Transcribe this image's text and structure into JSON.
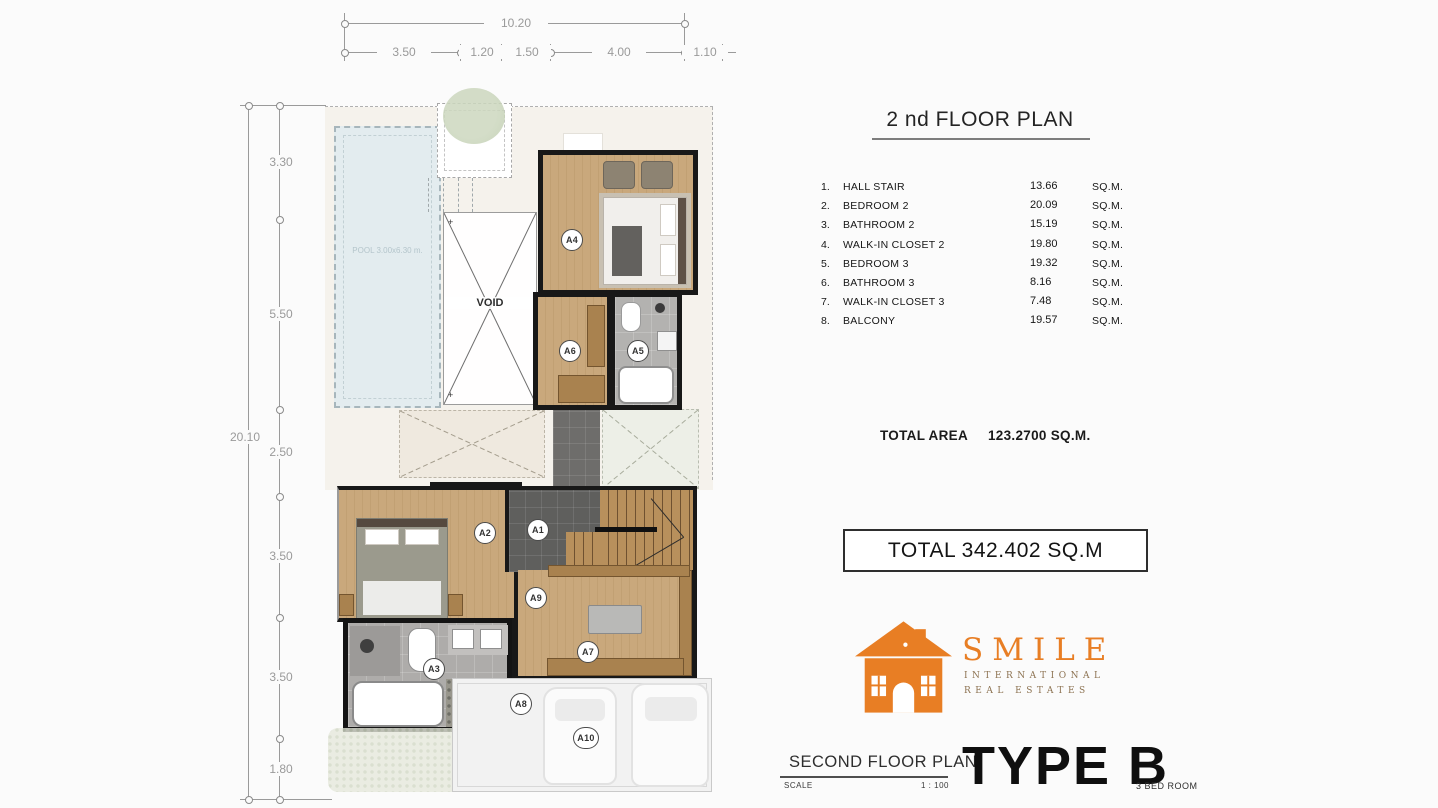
{
  "header": {
    "title": "2 nd FLOOR PLAN"
  },
  "legend": {
    "rows": [
      {
        "no": "1.",
        "name": "HALL STAIR",
        "area": "13.66",
        "unit": "SQ.M."
      },
      {
        "no": "2.",
        "name": "BEDROOM 2",
        "area": "20.09",
        "unit": "SQ.M."
      },
      {
        "no": "3.",
        "name": "BATHROOM 2",
        "area": "15.19",
        "unit": "SQ.M."
      },
      {
        "no": "4.",
        "name": "WALK-IN CLOSET 2",
        "area": "19.80",
        "unit": "SQ.M."
      },
      {
        "no": "5.",
        "name": "BEDROOM 3",
        "area": "19.32",
        "unit": "SQ.M."
      },
      {
        "no": "6.",
        "name": "BATHROOM 3",
        "area": "8.16",
        "unit": "SQ.M."
      },
      {
        "no": "7.",
        "name": "WALK-IN CLOSET 3",
        "area": "7.48",
        "unit": "SQ.M."
      },
      {
        "no": "8.",
        "name": "BALCONY",
        "area": "19.57",
        "unit": "SQ.M."
      }
    ]
  },
  "totals": {
    "area_label": "TOTAL AREA",
    "area_value": "123.2700 SQ.M.",
    "grand_total": "TOTAL 342.402 SQ.M"
  },
  "logo": {
    "brand": "SMILE",
    "sub1": "INTERNATIONAL",
    "sub2": "REAL ESTATES"
  },
  "footer": {
    "plan_name": "SECOND FLOOR PLAN",
    "scale_label": "SCALE",
    "scale_value": "1 : 100",
    "type_label": "TYPE B",
    "bedroom_label": "3 BED ROOM"
  },
  "dimensions": {
    "top_overall": "10.20",
    "top_segments": [
      "3.50",
      "1.20",
      "1.50",
      "4.00",
      "1.10"
    ],
    "left_overall": "20.10",
    "left_segments": [
      "3.30",
      "5.50",
      "2.50",
      "3.50",
      "3.50",
      "1.80"
    ]
  },
  "plan": {
    "void_label": "VOID",
    "pool_label": "POOL 3.00x6.30 m.",
    "markers": [
      "A1",
      "A2",
      "A3",
      "A4",
      "A5",
      "A6",
      "A7",
      "A8",
      "A9",
      "A10"
    ]
  },
  "colors": {
    "accent_orange": "#E87E24",
    "logo_subtext": "#8D7352",
    "wall_black": "#181818",
    "wood_floor": "#C9A87C",
    "tile_gray": "#B3B2B0",
    "pool_blue": "#E3ECEF",
    "dim_gray": "#9A9A9A"
  }
}
